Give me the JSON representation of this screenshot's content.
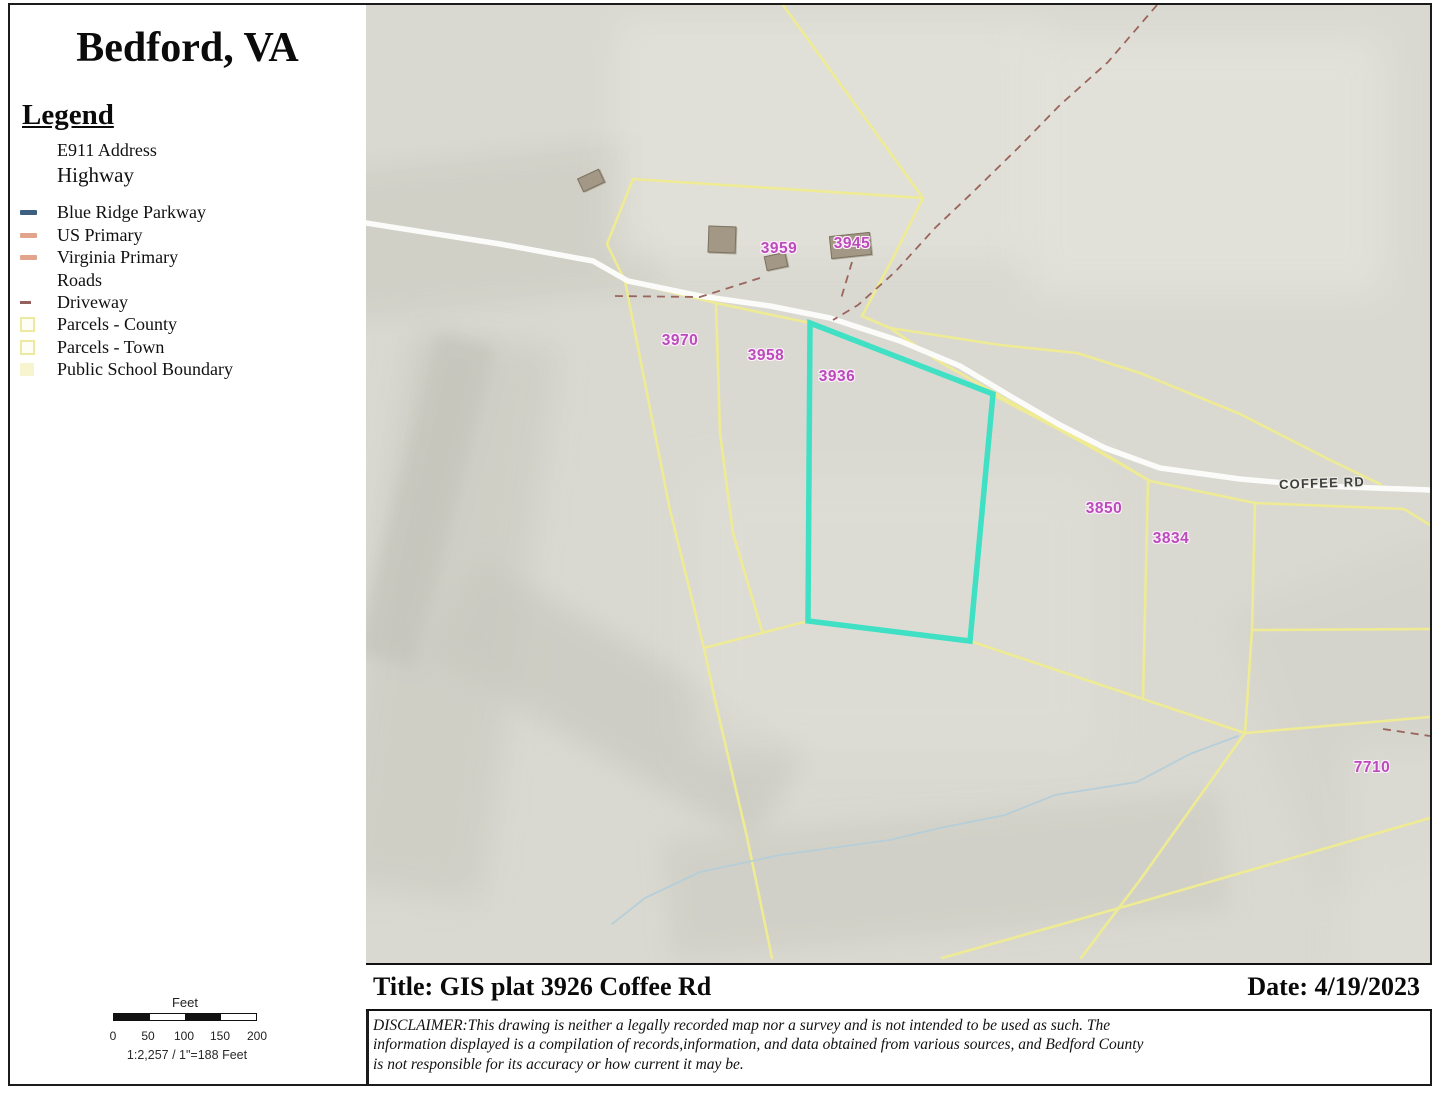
{
  "sidebar": {
    "title": "Bedford, VA",
    "legend_title": "Legend",
    "items": [
      {
        "label": "E911 Address",
        "swatch": "none"
      },
      {
        "label": "Highway",
        "swatch": "none"
      },
      {
        "label": "Blue Ridge Parkway",
        "swatch": "line-blue"
      },
      {
        "label": "US Primary",
        "swatch": "line-salmon"
      },
      {
        "label": "Virginia Primary",
        "swatch": "line-salmon"
      },
      {
        "label": "Roads",
        "swatch": "none"
      },
      {
        "label": "Driveway",
        "swatch": "line-driveway"
      },
      {
        "label": "Parcels - County",
        "swatch": "square-yellow"
      },
      {
        "label": "Parcels - Town",
        "swatch": "square-yellow"
      },
      {
        "label": "Public School Boundary",
        "swatch": "fill-paleyellow"
      }
    ],
    "scale": {
      "unit_label": "Feet",
      "ticks": [
        "0",
        "50",
        "100",
        "150",
        "200"
      ],
      "ratio": "1:2,257 / 1\"=188 Feet"
    }
  },
  "map": {
    "road_label": "COFFEE RD",
    "highlighted_parcel": "3936",
    "parcel_labels": [
      "3959",
      "3945",
      "3970",
      "3958",
      "3936",
      "3850",
      "3834",
      "7710"
    ],
    "colors": {
      "highlight_outline": "#3fe0c4",
      "parcel_line": "#eeeb94",
      "parcel_label": "#bb4abb",
      "road": "#ffffff",
      "driveway": "#9a655c",
      "stream": "#b3cdd9",
      "blue_ridge_parkway": "#3e5f80",
      "primary_highway": "#e2a48c",
      "terrain": "#d9d9d1"
    }
  },
  "footer": {
    "title_label": "Title: GIS plat 3926 Coffee Rd",
    "date_label": "Date: 4/19/2023",
    "disclaimer_lines": [
      "DISCLAIMER:This drawing is neither a legally recorded map nor a survey and is not intended to be used as such.  The",
      "information displayed is a compilation of records,information, and data obtained from various sources, and Bedford County",
      "is not responsible for its accuracy or how current it may be."
    ]
  }
}
